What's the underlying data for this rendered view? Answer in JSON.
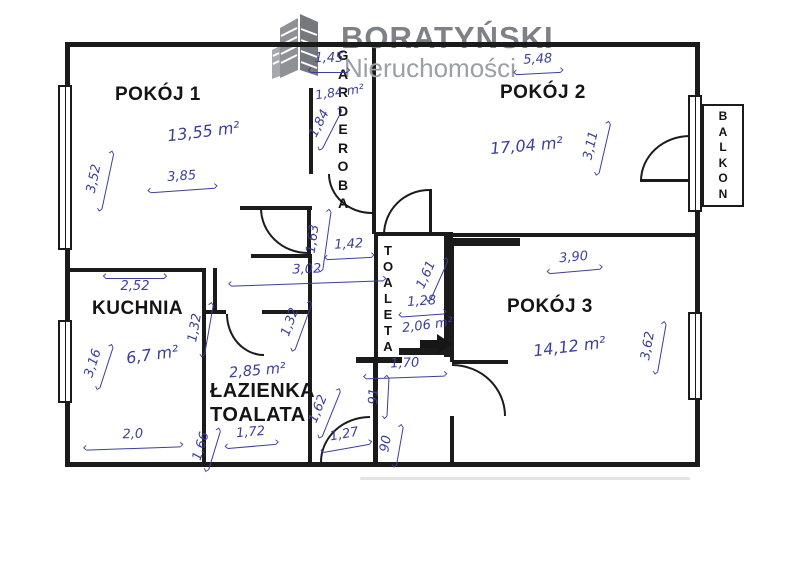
{
  "logo": {
    "brand": "BORATYŃSKI",
    "tagline": "Nieruchomości",
    "icon": "buildings-icon"
  },
  "colors": {
    "ink_blue": "#3a3f9b",
    "wall_black": "#1b1b1b",
    "logo_gray": "#7e8287",
    "logo_gray_light": "#9ba0a5"
  },
  "rooms": {
    "pokoj1": {
      "label": "POKÓJ 1",
      "area": "13,55 m²"
    },
    "pokoj2": {
      "label": "POKÓJ 2",
      "area": "17,04 m²"
    },
    "pokoj3": {
      "label": "POKÓJ 3",
      "area": "14,12 m²"
    },
    "kuchnia": {
      "label": "KUCHNIA",
      "area": "6,7 m²"
    },
    "lazienka": {
      "label_line1": "ŁAZIENKA",
      "label_line2": "TOALATA",
      "area": "2,85 m²"
    },
    "garderoba": {
      "label": "GARDEROBA",
      "area": "1,84 m²"
    },
    "toaleta": {
      "label": "TOALETA",
      "area": "2,06 m²"
    },
    "balkon": {
      "label": "BALKON"
    }
  },
  "dimensions": {
    "pokoj1_width": "3,85",
    "pokoj1_height": "3,52",
    "garderoba_top": "1,45",
    "garderoba_height": "1,84",
    "pokoj2_width": "5,48",
    "pokoj2_height": "3,11",
    "corridor_163": "1,63",
    "corridor_142": "1,42",
    "corridor_302": "3,02",
    "kuchnia_width": "2,52",
    "kuchnia_height": "3,16",
    "kuchnia_door_132": "1,32",
    "lazienka_door_132": "1,32",
    "kuchnia_bottom_20": "2,0",
    "lazienka_166": "1,66",
    "lazienka_172": "1,72",
    "hall_162": "1,62",
    "hall_127": "1,27",
    "hall_91": "91",
    "hall_90": "90",
    "toaleta_161": "1,61",
    "toaleta_128": "1,28",
    "toaleta_170": "1,70",
    "pokoj3_width": "3,90",
    "pokoj3_height": "3,62"
  }
}
